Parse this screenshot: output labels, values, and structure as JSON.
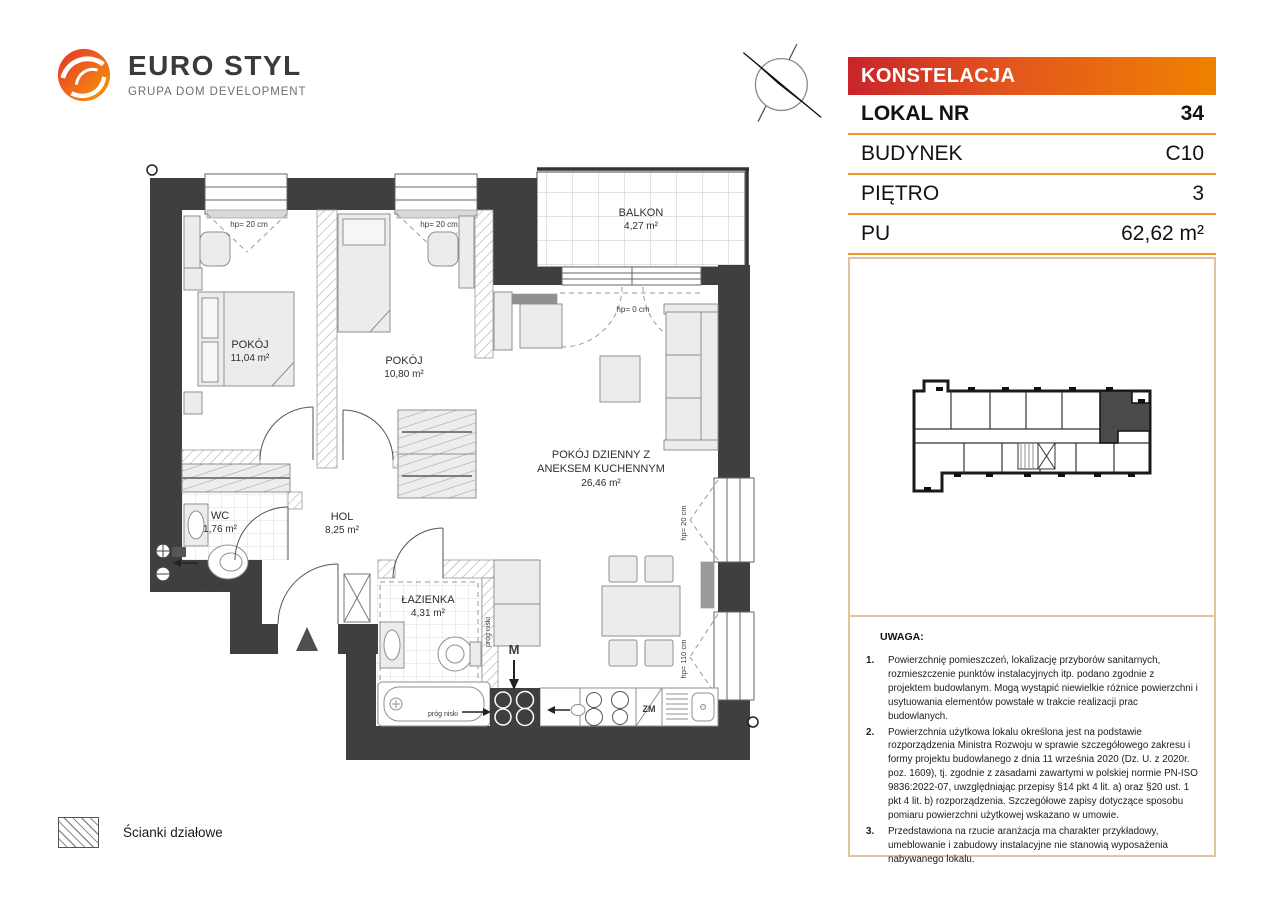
{
  "logo": {
    "title": "EURO STYL",
    "subtitle": "GRUPA DOM DEVELOPMENT"
  },
  "header": {
    "project": "KONSTELACJA",
    "rows": [
      {
        "label": "LOKAL NR",
        "value": "34"
      },
      {
        "label": "BUDYNEK",
        "value": "C10"
      },
      {
        "label": "PIĘTRO",
        "value": "3"
      },
      {
        "label": "PU",
        "value": "62,62 m²"
      }
    ]
  },
  "rooms": [
    {
      "line1": "POKÓJ",
      "area": "11,04 m²"
    },
    {
      "line1": "POKÓJ",
      "area": "10,80 m²"
    },
    {
      "line1": "POKÓJ DZIENNY Z",
      "line2": "ANEKSEM KUCHENNYM",
      "area": "26,46 m²"
    },
    {
      "line1": "HOL",
      "area": "8,25 m²"
    },
    {
      "line1": "WC",
      "area": "1,76 m²"
    },
    {
      "line1": "ŁAZIENKA",
      "area": "4,31 m²"
    },
    {
      "line1": "BALKON",
      "area": "4,27 m²"
    }
  ],
  "annotations": {
    "hp_20": "hp= 20 cm",
    "hp_0": "hp= 0 cm",
    "hp_110": "hp= 110 cm",
    "prog_niski": "próg niski",
    "washing_machine": "M",
    "dishwasher": "ZM"
  },
  "legend": {
    "label": "Ścianki działowe"
  },
  "notes": {
    "heading": "UWAGA:",
    "items": [
      {
        "n": "1.",
        "text": "Powierzchnię pomieszczeń, lokalizację przyborów sanitarnych, rozmieszczenie punktów instalacyjnych itp. podano zgodnie z projektem budowlanym. Mogą wystąpić niewielkie różnice powierzchni i usytuowania elementów powstałe w trakcie realizacji prac budowlanych."
      },
      {
        "n": "2.",
        "text": "Powierzchnia użytkowa lokalu określona jest na podstawie rozporządzenia Ministra Rozwoju w sprawie szczegółowego zakresu i formy projektu budowlanego z dnia 11 września 2020 (Dz. U. z 2020r. poz. 1609), tj. zgodnie z zasadami zawartymi w polskiej normie PN-ISO 9836:2022-07, uwzględniając przepisy §14 pkt 4 lit. a) oraz §20 ust. 1 pkt 4 lit. b) rozporządzenia. Szczegółowe zapisy dotyczące sposobu pomiaru powierzchni użytkowej wskazano w umowie."
      },
      {
        "n": "3.",
        "text": "Przedstawiona na rzucie aranżacja ma charakter przykładowy, umeblowanie i zabudowy instalacyjne nie stanowią wyposażenia nabywanego lokalu."
      }
    ]
  },
  "colors": {
    "accent_red": "#c9242b",
    "accent_orange": "#ef8200",
    "table_border": "#f0962e",
    "panel_border": "#dfc49c",
    "wall": "#3f3f3f"
  }
}
